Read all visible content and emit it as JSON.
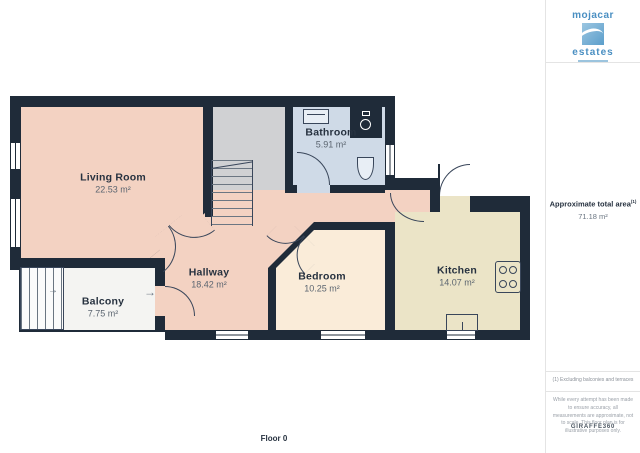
{
  "branding": {
    "name_top": "mojacar",
    "name_bottom": "estates",
    "brand_color": "#4a8fc2"
  },
  "sidebar": {
    "total_area_label": "Approximate total area",
    "total_area_sup": "(1)",
    "total_area_value": "71.18 m²",
    "footnote": "(1) Excluding balconies and terraces",
    "disclaimer": "While every attempt has been made to ensure accuracy, all measurements are approximate, not to scale. This floor plan is for illustrative purposes only.",
    "credit": "GIRAFFE360"
  },
  "plan": {
    "floor_label": "Floor 0"
  },
  "rooms": [
    {
      "name": "Living Room",
      "area": "22.53 m²"
    },
    {
      "name": "Bathroom",
      "area": "5.91 m²"
    },
    {
      "name": "Hallway",
      "area": "18.42 m²"
    },
    {
      "name": "Bedroom",
      "area": "10.25 m²"
    },
    {
      "name": "Kitchen",
      "area": "14.07 m²"
    },
    {
      "name": "Balcony",
      "area": "7.75 m²"
    }
  ],
  "icons": {
    "arrow_right": "→"
  },
  "colors": {
    "wall": "#1f2b39",
    "living_hall_floor": "#f3d2c2",
    "bedroom_floor": "#faecd9",
    "kitchen_floor": "#ebe4c7",
    "bathroom_floor": "#cfdae7",
    "stairwell_floor": "#d0d1d3",
    "balcony_floor": "#f4f4f2",
    "brand_blue": "#4a8fc2"
  }
}
